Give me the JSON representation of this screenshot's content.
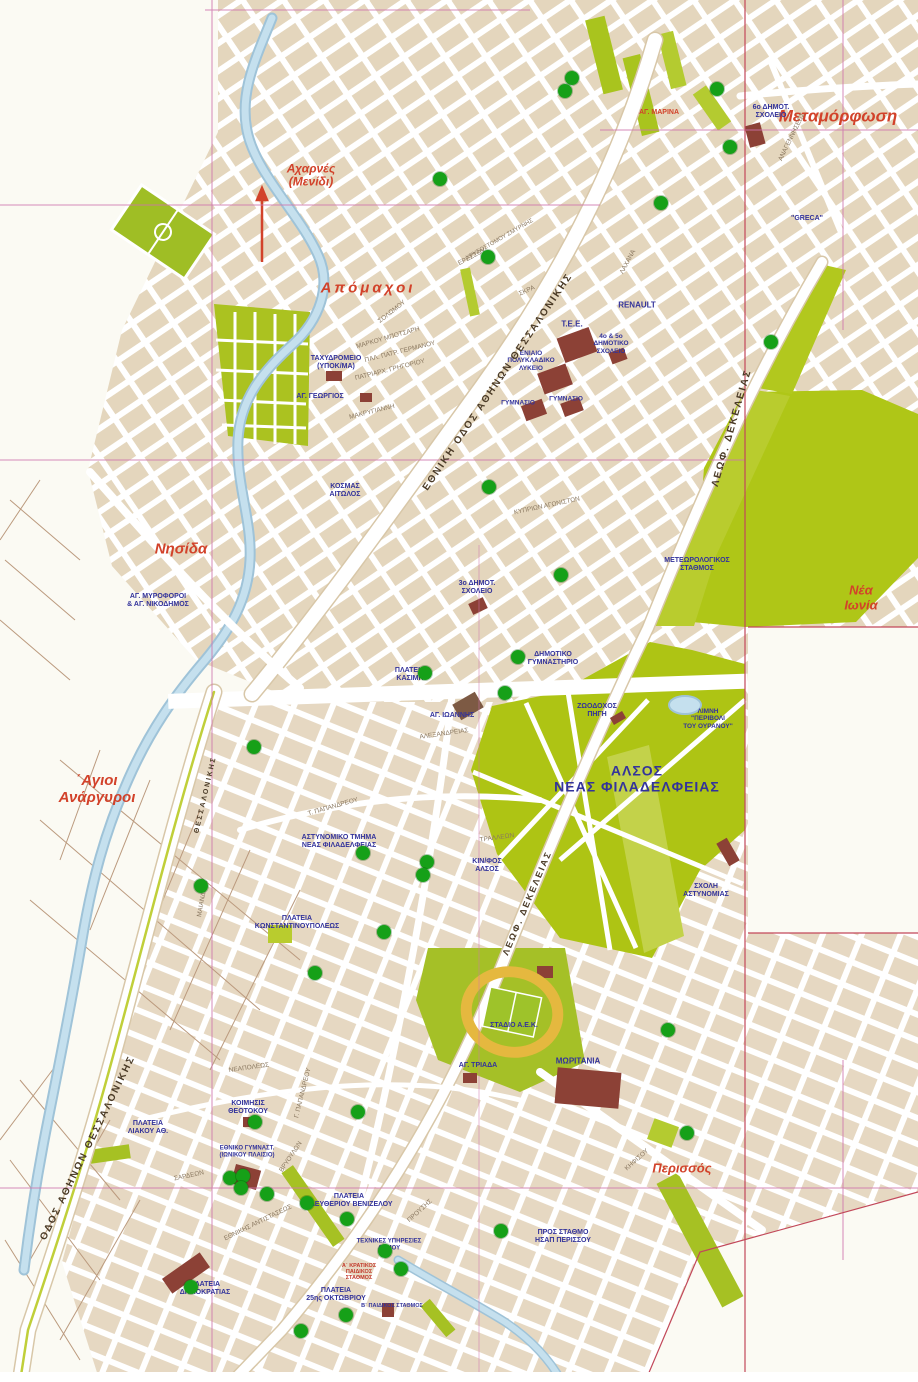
{
  "canvas": {
    "w": 918,
    "h": 1382
  },
  "map": {
    "colors": {
      "paper": "#fbfaf3",
      "block": "#e4d6bd",
      "road": "#ffffff",
      "park_green": "#aec414",
      "river_blue": "#c5e0ee",
      "building_red": "#8c4136",
      "marker_green": "#16a018",
      "grid_magenta": "#cf74ad",
      "sheet_edge_red": "#c2485a",
      "label_red": "#d2422a",
      "label_blue": "#33339b"
    },
    "markers": [
      [
        572,
        78
      ],
      [
        565,
        91
      ],
      [
        717,
        89
      ],
      [
        730,
        147
      ],
      [
        661,
        203
      ],
      [
        440,
        179
      ],
      [
        488,
        257
      ],
      [
        771,
        342
      ],
      [
        489,
        487
      ],
      [
        561,
        575
      ],
      [
        518,
        657
      ],
      [
        425,
        673
      ],
      [
        505,
        693
      ],
      [
        254,
        747
      ],
      [
        201,
        886
      ],
      [
        363,
        853
      ],
      [
        427,
        862
      ],
      [
        423,
        875
      ],
      [
        384,
        932
      ],
      [
        315,
        973
      ],
      [
        668,
        1030
      ],
      [
        687,
        1133
      ],
      [
        255,
        1122
      ],
      [
        358,
        1112
      ],
      [
        230,
        1178
      ],
      [
        243,
        1176
      ],
      [
        241,
        1188
      ],
      [
        267,
        1194
      ],
      [
        307,
        1203
      ],
      [
        347,
        1219
      ],
      [
        385,
        1251
      ],
      [
        401,
        1269
      ],
      [
        346,
        1315
      ],
      [
        301,
        1331
      ],
      [
        191,
        1287
      ],
      [
        501,
        1231
      ]
    ],
    "labels": [
      {
        "n": "label-metamorfosi",
        "cls": "red-lg",
        "t": "Μεταμόρφωση",
        "x": 838,
        "y": 116,
        "s": 17
      },
      {
        "n": "label-acharnes",
        "cls": "red-lg",
        "t": "Αχαρνές\n(Μενίδι)",
        "x": 311,
        "y": 176,
        "s": 12
      },
      {
        "n": "label-apomachoi",
        "cls": "red-lg",
        "t": "Απόμαχοι",
        "x": 368,
        "y": 289,
        "s": 15,
        "ls": 3
      },
      {
        "n": "label-nisida",
        "cls": "red-lg",
        "t": "Νησίδα",
        "x": 181,
        "y": 550,
        "s": 15
      },
      {
        "n": "label-nea-ionia",
        "cls": "red-lg",
        "t": "Νέα  Ιωνία",
        "x": 861,
        "y": 598,
        "s": 13
      },
      {
        "n": "label-agioi-anargyroi",
        "cls": "red-lg",
        "t": "΄Αγιοι\nΑνάργυροι",
        "x": 97,
        "y": 790,
        "s": 15
      },
      {
        "n": "label-perissos",
        "cls": "red-lg",
        "t": "Περισσός",
        "x": 682,
        "y": 1169,
        "s": 13
      },
      {
        "n": "label-ag-marina",
        "cls": "red-sm",
        "t": "ΑΓ. ΜΑΡΙΝΑ",
        "x": 659,
        "y": 113,
        "s": 7
      },
      {
        "n": "label-alsos",
        "cls": "blue-lg",
        "t": "ΑΛΣΟΣ\nΝΕΑΣ ΦΙΛΑΔΕΛΦΕΙΑΣ",
        "x": 637,
        "y": 779,
        "s": 14
      },
      {
        "n": "label-6-dimot-scholeio",
        "cls": "blue",
        "t": "6ο ΔΗΜΟΤ.\nΣΧΟΛΕΙΟ",
        "x": 771,
        "y": 112,
        "s": 7
      },
      {
        "n": "label-greca",
        "cls": "blue",
        "t": "\"GRECA\"",
        "x": 807,
        "y": 219,
        "s": 7
      },
      {
        "n": "label-renault",
        "cls": "blue",
        "t": "RENAULT",
        "x": 637,
        "y": 306,
        "s": 8
      },
      {
        "n": "label-tee",
        "cls": "blue",
        "t": "Τ.Ε.Ε.",
        "x": 572,
        "y": 325,
        "s": 8
      },
      {
        "n": "label-4-5-dimotiko",
        "cls": "blue",
        "t": "4ο & 5ο\nΔΗΜΟΤΙΚΟ\nΣΧΟΛΕΙΟ",
        "x": 611,
        "y": 344,
        "s": 6.5
      },
      {
        "n": "label-polykladiko",
        "cls": "blue",
        "t": "ΕΝΙΑΙΟ\nΠΟΛΥΚΛΑΔΙΚΟ\nΛΥΚΕΙΟ",
        "x": 531,
        "y": 361,
        "s": 6.5
      },
      {
        "n": "label-gymnasio-1",
        "cls": "blue",
        "t": "ΓΥΜΝΑΣΙΟ",
        "x": 518,
        "y": 403,
        "s": 6.5
      },
      {
        "n": "label-gymnasio-2",
        "cls": "blue",
        "t": "ΓΥΜΝΑΣΙΟ",
        "x": 566,
        "y": 399,
        "s": 6.5
      },
      {
        "n": "label-tachydromeio",
        "cls": "blue",
        "t": "ΤΑΧΥΔΡΟΜΕΙΟ\n(ΥΠΟΚ/ΜΑ)",
        "x": 336,
        "y": 363,
        "s": 7
      },
      {
        "n": "label-ag-georgios",
        "cls": "blue",
        "t": "ΑΓ. ΓΕΩΡΓΙΟΣ",
        "x": 320,
        "y": 397,
        "s": 7
      },
      {
        "n": "label-kosmas-aitolos",
        "cls": "blue",
        "t": "ΚΟΣΜΑΣ\nΑΙΤΩΛΟΣ",
        "x": 345,
        "y": 491,
        "s": 7
      },
      {
        "n": "label-ag-myroforoi",
        "cls": "blue",
        "t": "ΑΓ. ΜΥΡΟΦΟΡΟΙ\n& ΑΓ. ΝΙΚΟΔΗΜΟΣ",
        "x": 158,
        "y": 601,
        "s": 7
      },
      {
        "n": "label-meteorologikos",
        "cls": "blue",
        "t": "ΜΕΤΕΩΡΟΛΟΓΙΚΟΣ\nΣΤΑΘΜΟΣ",
        "x": 697,
        "y": 565,
        "s": 7
      },
      {
        "n": "label-3-dimot-scholeio",
        "cls": "blue",
        "t": "3ο ΔΗΜΟΤ.\nΣΧΟΛΕΙΟ",
        "x": 477,
        "y": 588,
        "s": 7
      },
      {
        "n": "label-dimotiko-gymnastirio",
        "cls": "blue",
        "t": "ΔΗΜΟΤΙΚΟ\nΓΥΜΝΑΣΤΗΡΙΟ",
        "x": 553,
        "y": 659,
        "s": 7
      },
      {
        "n": "label-plateia-kasimi",
        "cls": "blue",
        "t": "ΠΛΑΤΕΙΑ\nΚΑΣΙΜΗ",
        "x": 410,
        "y": 675,
        "s": 7
      },
      {
        "n": "label-ag-ioannis",
        "cls": "blue",
        "t": "ΑΓ. ΙΩΑΝΝΗΣ",
        "x": 452,
        "y": 716,
        "s": 7
      },
      {
        "n": "label-zoodochos-pigi",
        "cls": "blue",
        "t": "ΖΩΟΔΟΧΟΣ\nΠΗΓΗ",
        "x": 597,
        "y": 711,
        "s": 7
      },
      {
        "n": "label-limni-perivoli",
        "cls": "blue",
        "t": "ΛΙΜΝΗ\n\"ΠΕΡΙΒΟΛΙ\nΤΟΥ ΟΥΡΑΝΟΥ\"",
        "x": 708,
        "y": 719,
        "s": 6.5
      },
      {
        "n": "label-scholi-astynomias",
        "cls": "blue",
        "t": "ΣΧΟΛΗ\nΑΣΤΥΝΟΜΙΑΣ",
        "x": 706,
        "y": 891,
        "s": 7
      },
      {
        "n": "label-astynomiko-tmima",
        "cls": "blue",
        "t": "ΑΣΤΥΝΟΜΙΚΟ ΤΜΗΜΑ\nΝΕΑΣ ΦΙΛΑΔΕΛΦΕΙΑΣ",
        "x": 339,
        "y": 842,
        "s": 7
      },
      {
        "n": "label-kinfos-alsos",
        "cls": "blue",
        "t": "ΚΙΝ/ΦΟΣ\nΑΛΣΟΣ",
        "x": 487,
        "y": 866,
        "s": 7
      },
      {
        "n": "label-plateia-konstantinoupoleos",
        "cls": "blue",
        "t": "ΠΛΑΤΕΙΑ\nΚΩΝΣΤΑΝΤΙΝΟΥΠΟΛΕΩΣ",
        "x": 297,
        "y": 923,
        "s": 7
      },
      {
        "n": "label-stadio-aek",
        "cls": "blue",
        "t": "ΣΤΑΔΙΟ Α.Ε.Κ.",
        "x": 514,
        "y": 1026,
        "s": 7
      },
      {
        "n": "label-ag-triada",
        "cls": "blue",
        "t": "ΑΓ. ΤΡΙΑΔΑ",
        "x": 478,
        "y": 1066,
        "s": 7
      },
      {
        "n": "label-moritania",
        "cls": "blue",
        "t": "ΜΩΡΙΤΑΝΙΑ",
        "x": 578,
        "y": 1062,
        "s": 8
      },
      {
        "n": "label-plateia-liakou",
        "cls": "blue",
        "t": "ΠΛΑΤΕΙΑ\nΛΙΑΚΟΥ ΑΘ.",
        "x": 148,
        "y": 1128,
        "s": 7
      },
      {
        "n": "label-koimisis-theotokou",
        "cls": "blue",
        "t": "ΚΟΙΜΗΣΙΣ\nΘΕΟΤΟΚΟΥ",
        "x": 248,
        "y": 1108,
        "s": 7
      },
      {
        "n": "label-ethniko-gymnastirio",
        "cls": "blue",
        "t": "ΕΘΝΙΚΟ ΓΥΜΝΑΣΤ.\n(ΙΩΝΙΚΟΥ ΠΛΑΙΣΙΟ)",
        "x": 247,
        "y": 1152,
        "s": 6
      },
      {
        "n": "label-plateia-venizelou",
        "cls": "blue",
        "t": "ΠΛΑΤΕΙΑ\nΕΛΕΥΘΕΡΙΟΥ ΒΕΝΙΖΕΛΟΥ",
        "x": 349,
        "y": 1201,
        "s": 7
      },
      {
        "n": "label-techn-ypiresies",
        "cls": "blue",
        "t": "ΤΕΧΝΙΚΕΣ ΥΠΗΡΕΣΙΕΣ\nΔΗΜΟΥ",
        "x": 389,
        "y": 1245,
        "s": 6
      },
      {
        "n": "label-a-paidikos",
        "cls": "red-poi",
        "t": "Α΄ ΚΡΑΤΙΚΟΣ\nΠΑΙΔΙΚΟΣ\nΣΤΑΘΜΟΣ",
        "x": 359,
        "y": 1272,
        "s": 5.5
      },
      {
        "n": "label-b-paidikos",
        "cls": "blue",
        "t": "Β΄ ΠΑΙΔΙΚΟΣ ΣΤΑΘΜΟΣ",
        "x": 392,
        "y": 1306,
        "s": 5.5
      },
      {
        "n": "label-plateia-25-oktovriou",
        "cls": "blue",
        "t": "ΠΛΑΤΕΙΑ\n25ης ΟΚΤΩΒΡΙΟΥ",
        "x": 336,
        "y": 1295,
        "s": 7
      },
      {
        "n": "label-plateia-dimokratias",
        "cls": "blue",
        "t": "ΠΛΑΤΕΙΑ\nΔΗΜΟΚΡΑΤΙΑΣ",
        "x": 205,
        "y": 1289,
        "s": 7
      },
      {
        "n": "label-pros-stathmo-isap",
        "cls": "blue",
        "t": "ΠΡΟΣ ΣΤΑΘΜΟ\nΗΣΑΠ ΠΕΡΙΣΣΟΥ",
        "x": 563,
        "y": 1237,
        "s": 7
      },
      {
        "n": "road-ethniki-odos",
        "cls": "road",
        "t": "ΕΘΝΙΚΗ ΟΔΟΣ ΑΘΗΝΩΝ ΘΕΣΣΑΛΟΝΙΚΗΣ",
        "x": 498,
        "y": 382,
        "s": 10,
        "r": -56
      },
      {
        "n": "road-leof-dekeleias-1",
        "cls": "road",
        "t": "ΛΕΩΦ. ΔΕΚΕΛΕΙΑΣ",
        "x": 732,
        "y": 428,
        "s": 10,
        "r": -74
      },
      {
        "n": "road-leof-dekeleias-2",
        "cls": "road",
        "t": "ΛΕΩΦ. ΔΕΚΕΛΕΙΑΣ",
        "x": 527,
        "y": 903,
        "s": 9,
        "r": -67
      },
      {
        "n": "road-odos-athinon",
        "cls": "road",
        "t": "ΟΔΟΣ ΑΘΗΝΩΝ ΘΕΣΣΑΛΟΝΙΚΗΣ",
        "x": 88,
        "y": 1148,
        "s": 10,
        "r": -64
      },
      {
        "n": "road-thessalonikis",
        "cls": "road",
        "t": "ΘΕΣΣΑΛΟΝΙΚΗΣ",
        "x": 206,
        "y": 795,
        "s": 7,
        "r": -77
      },
      {
        "n": "street-name",
        "cls": "street",
        "t": "ΣΟΛΩΜΟΥ",
        "x": 392,
        "y": 312,
        "s": 6.5,
        "r": -38
      },
      {
        "n": "street-name",
        "cls": "street",
        "t": "ΜΑΡΚΟΥ ΜΠΟΤΣΑΡΗ",
        "x": 388,
        "y": 338,
        "s": 6.5,
        "r": -16
      },
      {
        "n": "street-name",
        "cls": "street",
        "t": "ΠΑΛ. ΠΑΤΡ. ΓΕΡΜΑΝΟΥ",
        "x": 400,
        "y": 352,
        "s": 6.5,
        "r": -14
      },
      {
        "n": "street-name",
        "cls": "street",
        "t": "ΠΑΤΡΙΑΡΧ. ΓΡΗΓΟΡΙΟΥ",
        "x": 390,
        "y": 370,
        "s": 6.5,
        "r": -14
      },
      {
        "n": "street-name",
        "cls": "street",
        "t": "ΕΡΕΣΣΟΥ",
        "x": 472,
        "y": 257,
        "s": 6.5,
        "r": -28
      },
      {
        "n": "street-name",
        "cls": "street",
        "t": "ΣΚΡΑ",
        "x": 527,
        "y": 291,
        "s": 6.5,
        "r": -24
      },
      {
        "n": "street-name",
        "cls": "street",
        "t": "ΛΑΧΑΝΑ",
        "x": 628,
        "y": 262,
        "s": 6.5,
        "r": -62
      },
      {
        "n": "street-name",
        "cls": "street",
        "t": "ΑΝΑΓΕΝΝΗΣΕΩΣ",
        "x": 792,
        "y": 137,
        "s": 6.5,
        "r": -64
      },
      {
        "n": "street-name",
        "cls": "street",
        "t": "ΧΡΥΣΟΣΤΟΜΟΥ ΣΜΥΡΝΗΣ",
        "x": 500,
        "y": 240,
        "s": 6,
        "r": -30
      },
      {
        "n": "street-name",
        "cls": "street",
        "t": "ΚΥΠΡΙΩΝ ΑΓΩΝΙΣΤΩΝ",
        "x": 547,
        "y": 506,
        "s": 6.5,
        "r": -12
      },
      {
        "n": "street-name",
        "cls": "street",
        "t": "ΜΑΚΡΥΓΙΑΝΝΗ",
        "x": 372,
        "y": 412,
        "s": 6.5,
        "r": -14
      },
      {
        "n": "street-name",
        "cls": "street",
        "t": "ΑΛΕΞΑΝΔΡΕΙΑΣ",
        "x": 444,
        "y": 734,
        "s": 6.5,
        "r": -8
      },
      {
        "n": "street-name",
        "cls": "street",
        "t": "ΤΡΑΛΛΕΩΝ",
        "x": 497,
        "y": 838,
        "s": 6.5,
        "r": -8
      },
      {
        "n": "street-name",
        "cls": "street",
        "t": "Τ. ΠΑΠΑΝΔΡΕΟΥ",
        "x": 333,
        "y": 807,
        "s": 6.5,
        "r": -16
      },
      {
        "n": "street-name",
        "cls": "street",
        "t": "ΜΑΙΑΝΔΡΟΥ",
        "x": 203,
        "y": 898,
        "s": 6.5,
        "r": -80
      },
      {
        "n": "street-name",
        "cls": "street",
        "t": "ΝΕΑΠΟΛΕΩΣ",
        "x": 249,
        "y": 1068,
        "s": 6.5,
        "r": -8
      },
      {
        "n": "street-name",
        "cls": "street",
        "t": "Γ. ΠΑΠΑΝΔΡΕΟΥ",
        "x": 303,
        "y": 1093,
        "s": 6.5,
        "r": -76
      },
      {
        "n": "street-name",
        "cls": "street",
        "t": "ΣΑΡΔΕΩΝ",
        "x": 189,
        "y": 1176,
        "s": 6.5,
        "r": -12
      },
      {
        "n": "street-name",
        "cls": "street",
        "t": "ΒΡΥΟΥΛΩΝ",
        "x": 291,
        "y": 1157,
        "s": 6.5,
        "r": -56
      },
      {
        "n": "street-name",
        "cls": "street",
        "t": "ΕΘΝΙΚΗΣ ΑΝΤΙΣΤΑΣΕΩΣ",
        "x": 258,
        "y": 1223,
        "s": 6.5,
        "r": -26
      },
      {
        "n": "street-name",
        "cls": "street",
        "t": "ΠΡΟΥΣΗΣ",
        "x": 420,
        "y": 1211,
        "s": 6.5,
        "r": -42
      },
      {
        "n": "street-name",
        "cls": "street",
        "t": "ΚΗΦΙΣΟΥ",
        "x": 637,
        "y": 1160,
        "s": 6.5,
        "r": -42
      }
    ]
  }
}
